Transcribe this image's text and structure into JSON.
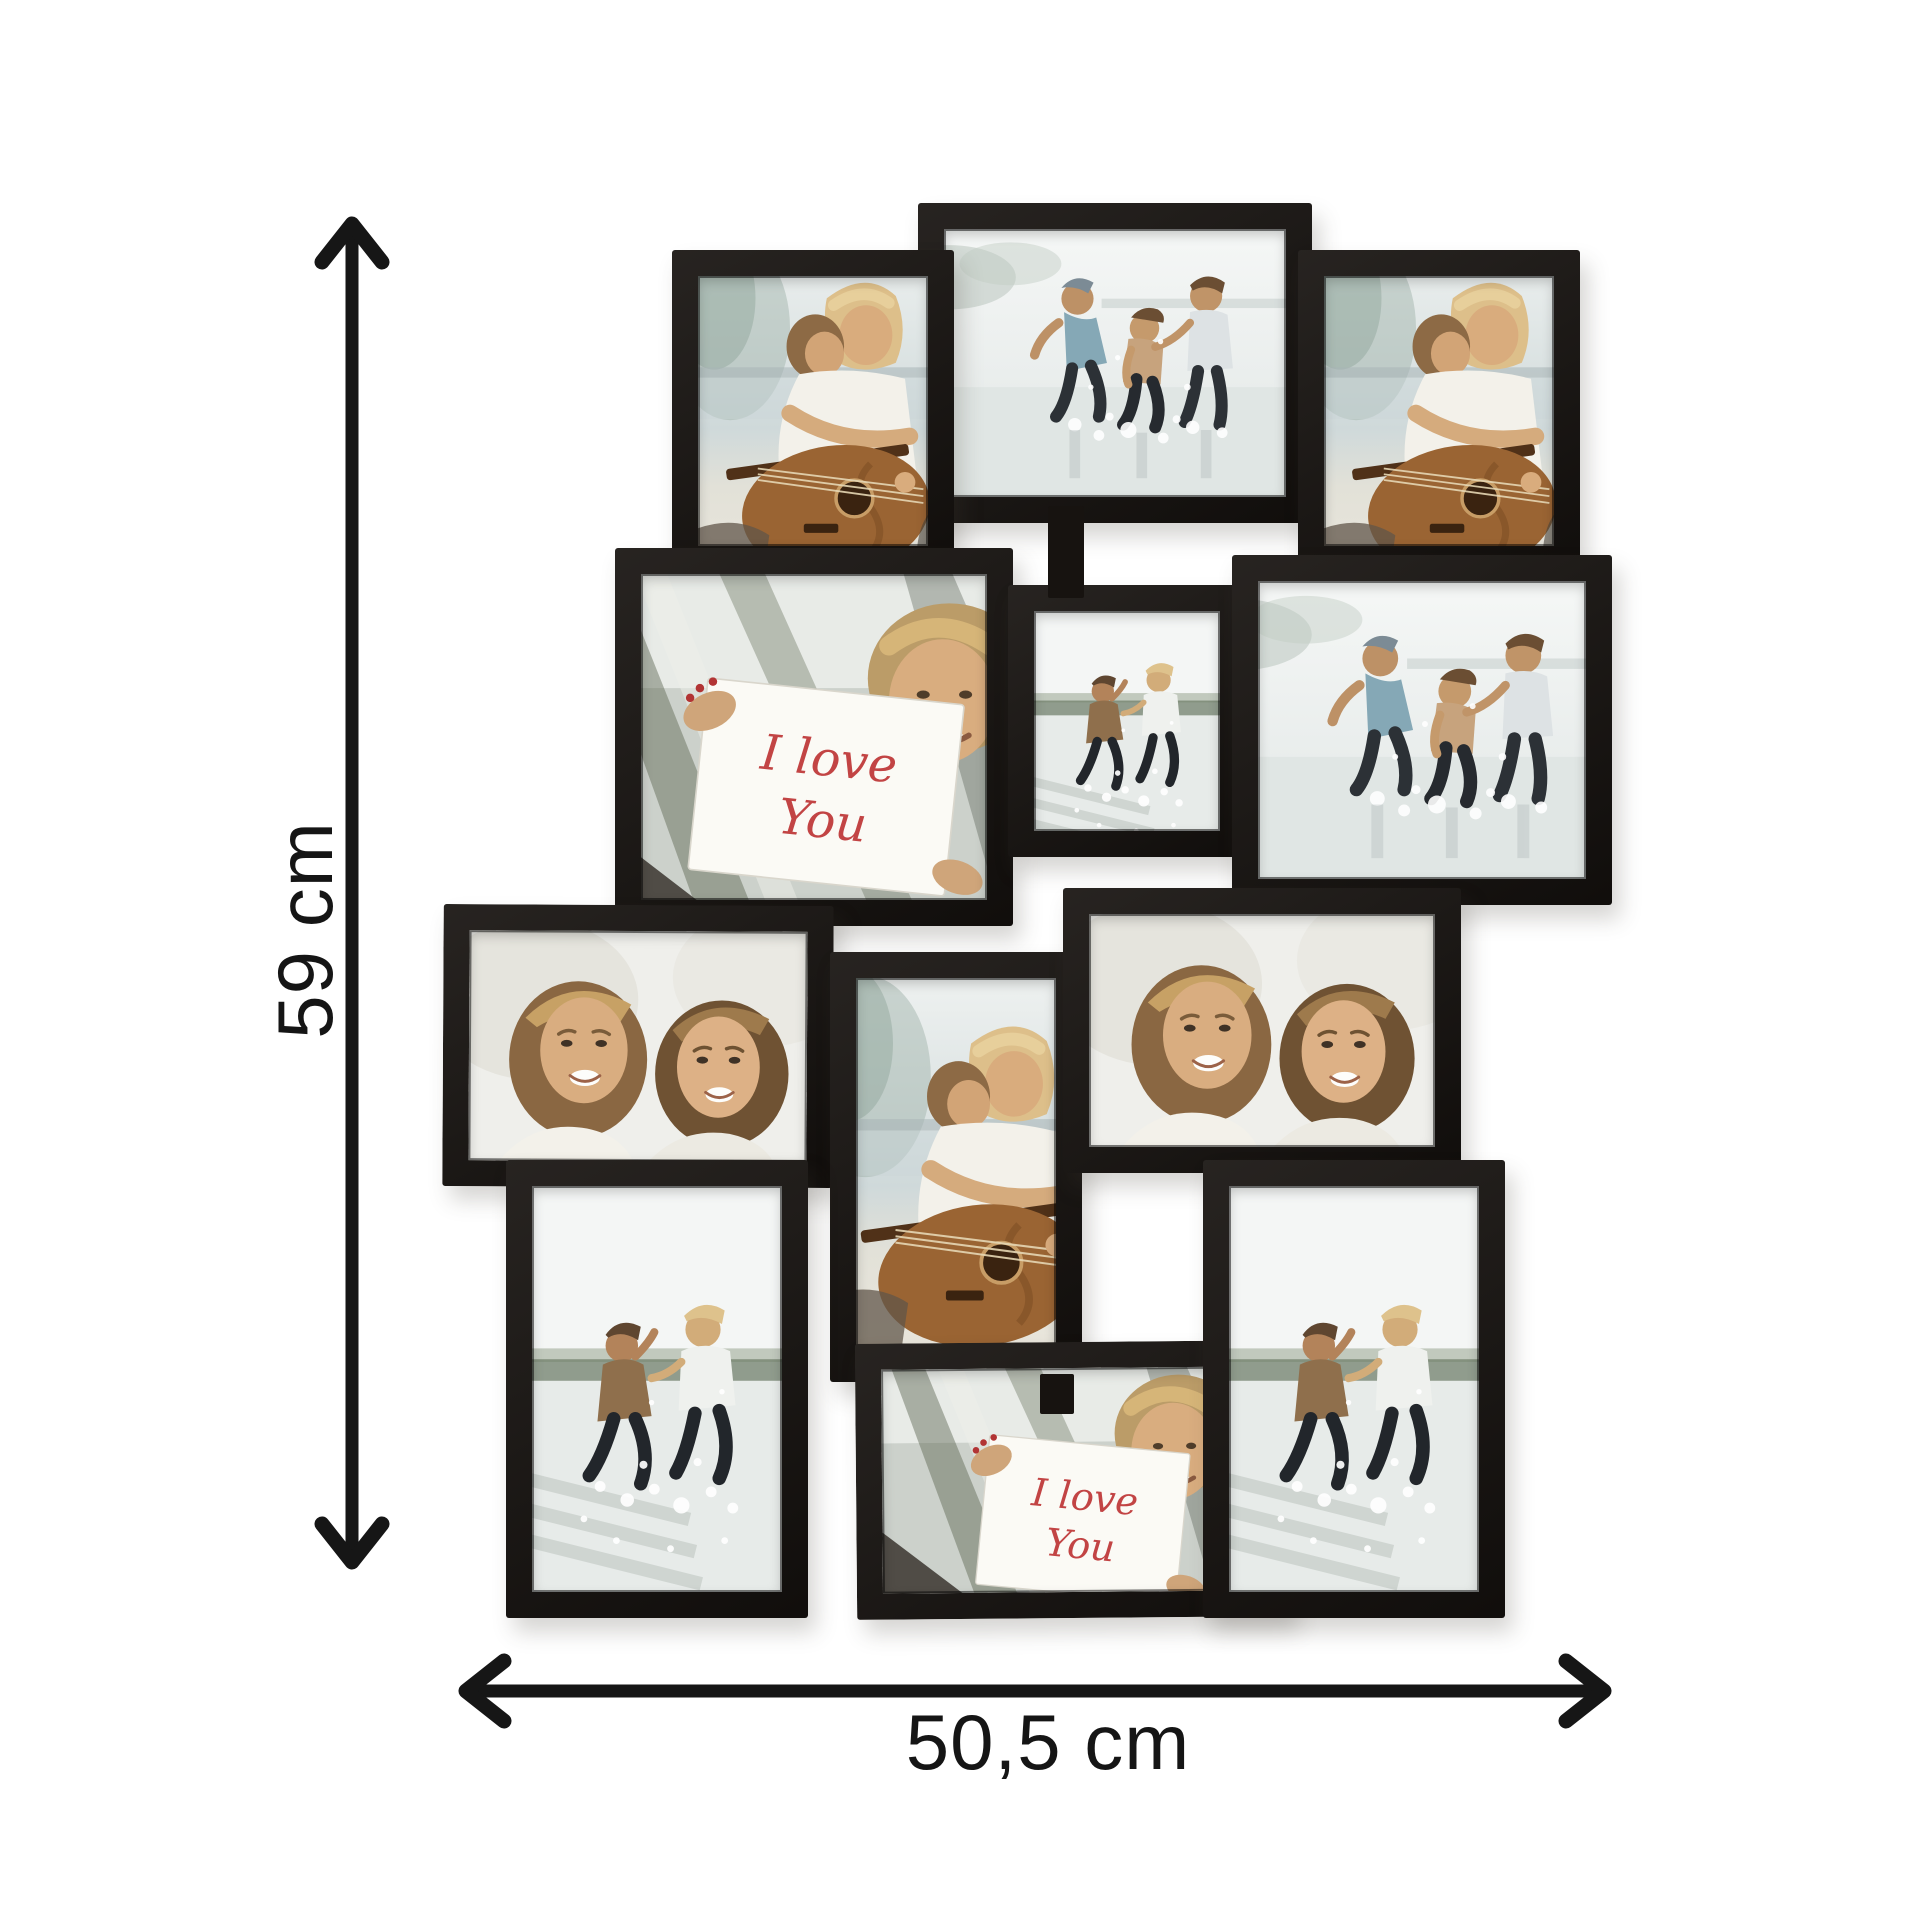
{
  "image": {
    "background": "#ffffff",
    "description": "black 12-photo collage picture frame shown with height and width dimension arrows"
  },
  "dimensions": {
    "height_label": "59 cm",
    "width_label": "50,5 cm",
    "arrow_color": "#161616",
    "label_color": "#151515"
  },
  "product": {
    "type": "multi-photo collage frame",
    "frame_color": "#171310",
    "photo_count": 12
  },
  "photos": {
    "guitar": {
      "description": "woman hugging friend who plays acoustic guitar by a lake"
    },
    "beach3": {
      "description": "three friends splashing in shallow water on a bright beach"
    },
    "running2": {
      "description": "two women running hand in hand through the water"
    },
    "loveyou": {
      "description": "smiling woman holding a white card with handwritten note",
      "card_line1": "I love",
      "card_line2": "You"
    },
    "blondes2": {
      "description": "two smiling women cheek to cheek"
    }
  },
  "collage": {
    "frames": [
      {
        "photo": "beach3",
        "orientation": "landscape",
        "x": 918,
        "y": 203,
        "w": 394,
        "h": 320,
        "tilt": 0
      },
      {
        "photo": "guitar",
        "orientation": "portrait",
        "x": 672,
        "y": 250,
        "w": 282,
        "h": 322,
        "tilt": 0
      },
      {
        "photo": "guitar",
        "orientation": "portrait",
        "x": 1298,
        "y": 250,
        "w": 282,
        "h": 322,
        "tilt": 0
      },
      {
        "photo": "loveyou",
        "orientation": "landscape",
        "x": 615,
        "y": 548,
        "w": 398,
        "h": 378,
        "tilt": 0
      },
      {
        "photo": "running2",
        "orientation": "portrait",
        "x": 1008,
        "y": 585,
        "w": 238,
        "h": 272,
        "tilt": 0
      },
      {
        "photo": "beach3",
        "orientation": "landscape",
        "x": 1232,
        "y": 555,
        "w": 380,
        "h": 350,
        "tilt": 0
      },
      {
        "photo": "blondes2",
        "orientation": "landscape",
        "x": 443,
        "y": 905,
        "w": 390,
        "h": 282,
        "tilt": 0.3
      },
      {
        "photo": "guitar",
        "orientation": "portrait",
        "x": 830,
        "y": 952,
        "w": 252,
        "h": 430,
        "tilt": 0
      },
      {
        "photo": "blondes2",
        "orientation": "landscape",
        "x": 1063,
        "y": 888,
        "w": 398,
        "h": 285,
        "tilt": 0
      },
      {
        "photo": "running2",
        "orientation": "portrait",
        "x": 506,
        "y": 1160,
        "w": 302,
        "h": 458,
        "tilt": 0
      },
      {
        "photo": "loveyou",
        "orientation": "landscape",
        "x": 856,
        "y": 1342,
        "w": 434,
        "h": 276,
        "tilt": -0.5
      },
      {
        "photo": "running2",
        "orientation": "portrait",
        "x": 1203,
        "y": 1160,
        "w": 302,
        "h": 458,
        "tilt": 0
      }
    ],
    "connectors": [
      {
        "x": 1048,
        "y": 506,
        "w": 36,
        "h": 92
      },
      {
        "x": 1040,
        "y": 1374,
        "w": 34,
        "h": 40
      }
    ]
  }
}
